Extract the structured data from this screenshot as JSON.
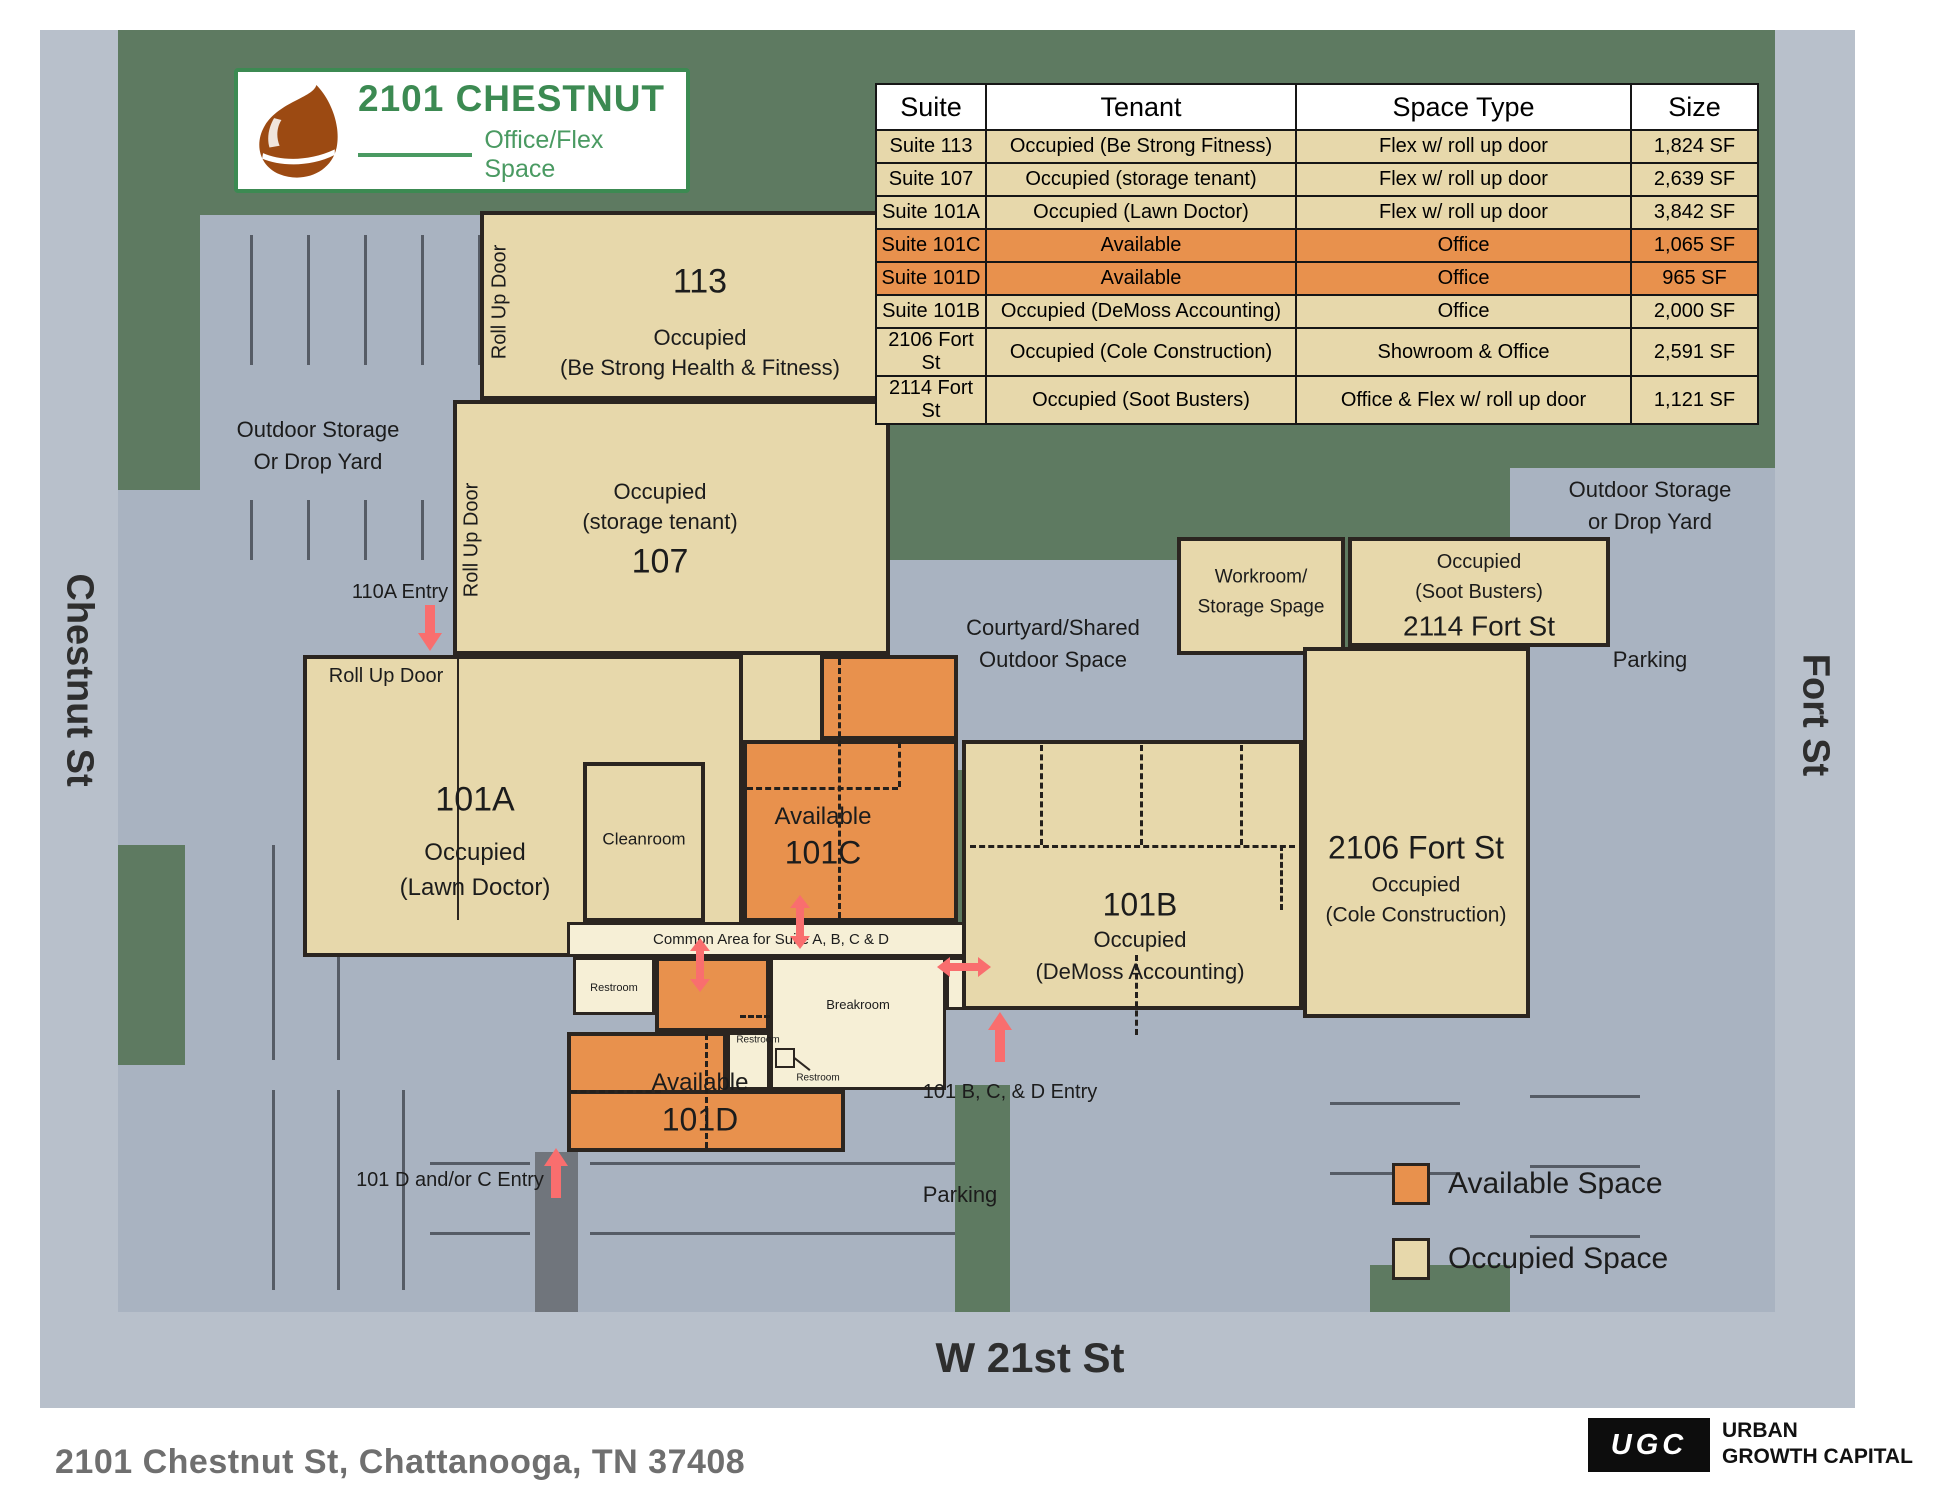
{
  "brand": {
    "title": "2101 CHESTNUT",
    "subtitle": "Office/Flex Space"
  },
  "table": {
    "headers": [
      "Suite",
      "Tenant",
      "Space Type",
      "Size"
    ],
    "rows": [
      {
        "suite": "Suite 113",
        "tenant": "Occupied (Be Strong Fitness)",
        "space_type": "Flex w/ roll up door",
        "size": "1,824 SF",
        "status": "occupied",
        "row_class": "row-occupied"
      },
      {
        "suite": "Suite 107",
        "tenant": "Occupied (storage tenant)",
        "space_type": "Flex w/ roll up door",
        "size": "2,639 SF",
        "status": "occupied",
        "row_class": "row-occupied"
      },
      {
        "suite": "Suite 101A",
        "tenant": "Occupied (Lawn Doctor)",
        "space_type": "Flex w/ roll up door",
        "size": "3,842 SF",
        "status": "occupied",
        "row_class": "row-occupied"
      },
      {
        "suite": "Suite 101C",
        "tenant": "Available",
        "space_type": "Office",
        "size": "1,065 SF",
        "status": "available",
        "row_class": "row-available"
      },
      {
        "suite": "Suite 101D",
        "tenant": "Available",
        "space_type": "Office",
        "size": "965 SF",
        "status": "available",
        "row_class": "row-available"
      },
      {
        "suite": "Suite 101B",
        "tenant": "Occupied (DeMoss Accounting)",
        "space_type": "Office",
        "size": "2,000 SF",
        "status": "occupied",
        "row_class": "row-occupied"
      },
      {
        "suite": "2106 Fort St",
        "tenant": "Occupied (Cole Construction)",
        "space_type": "Showroom & Office",
        "size": "2,591 SF",
        "status": "occupied",
        "row_class": "row-occupied"
      },
      {
        "suite": "2114 Fort St",
        "tenant": "Occupied (Soot Busters)",
        "space_type": "Office & Flex w/ roll up door",
        "size": "1,121 SF",
        "status": "occupied",
        "row_class": "row-occupied"
      }
    ]
  },
  "map": {
    "streets": {
      "left": "Chestnut St",
      "right": "Fort St",
      "bottom": "W 21st St"
    },
    "areas": {
      "storage_left_1": "Outdoor Storage",
      "storage_left_2": "Or Drop Yard",
      "storage_right_1": "Outdoor Storage",
      "storage_right_2": "or Drop Yard",
      "parking_right": "Parking",
      "parking_bottom": "Parking",
      "courtyard_1": "Courtyard/Shared",
      "courtyard_2": "Outdoor Space"
    },
    "suites": {
      "s113": {
        "num": "113",
        "l1": "Occupied",
        "l2": "(Be Strong Health & Fitness)",
        "rollup": "Roll Up Door"
      },
      "s107": {
        "l1": "Occupied",
        "l2": "(storage tenant)",
        "num": "107",
        "rollup": "Roll Up Door"
      },
      "s101a": {
        "num": "101A",
        "l1": "Occupied",
        "l2": "(Lawn Doctor)",
        "rollup": "Roll Up Door"
      },
      "s101c": {
        "l1": "Available",
        "num": "101C"
      },
      "s101d": {
        "l1": "Available",
        "num": "101D"
      },
      "s101b": {
        "num": "101B",
        "l1": "Occupied",
        "l2": "(DeMoss Accounting)"
      },
      "s2106": {
        "num": "2106 Fort St",
        "l1": "Occupied",
        "l2": "(Cole Construction)"
      },
      "s2114": {
        "l1": "Occupied",
        "l2": "(Soot Busters)",
        "num": "2114 Fort St"
      },
      "workroom_1": "Workroom/",
      "workroom_2": "Storage Spage",
      "cleanroom": "Cleanroom",
      "common_area": "Common Area for Suite A, B, C & D",
      "breakroom": "Breakroom",
      "restroom": "Restroom"
    },
    "entries": {
      "e110a": "110A Entry",
      "e101bcd": "101 B, C, & D Entry",
      "e101dc": "101 D and/or C Entry"
    },
    "legend": {
      "available": "Available Space",
      "occupied": "Occupied Space"
    }
  },
  "footer": {
    "address": "2101 Chestnut St, Chattanooga, TN 37408",
    "logo_abbr": "UGC",
    "logo_line1": "URBAN",
    "logo_line2": "GROWTH CAPITAL"
  },
  "colors": {
    "available": "#E8914D",
    "occupied": "#E7D8AB",
    "cream": "#F6EFD6",
    "green": "#5E7A61",
    "parking": "#A9B3C1",
    "street": "#B8C0CB",
    "wall": "#2B2520",
    "arrow": "#F96E6E",
    "brand_green": "#3C8A52",
    "chestnut_brown": "#9C4A12"
  }
}
